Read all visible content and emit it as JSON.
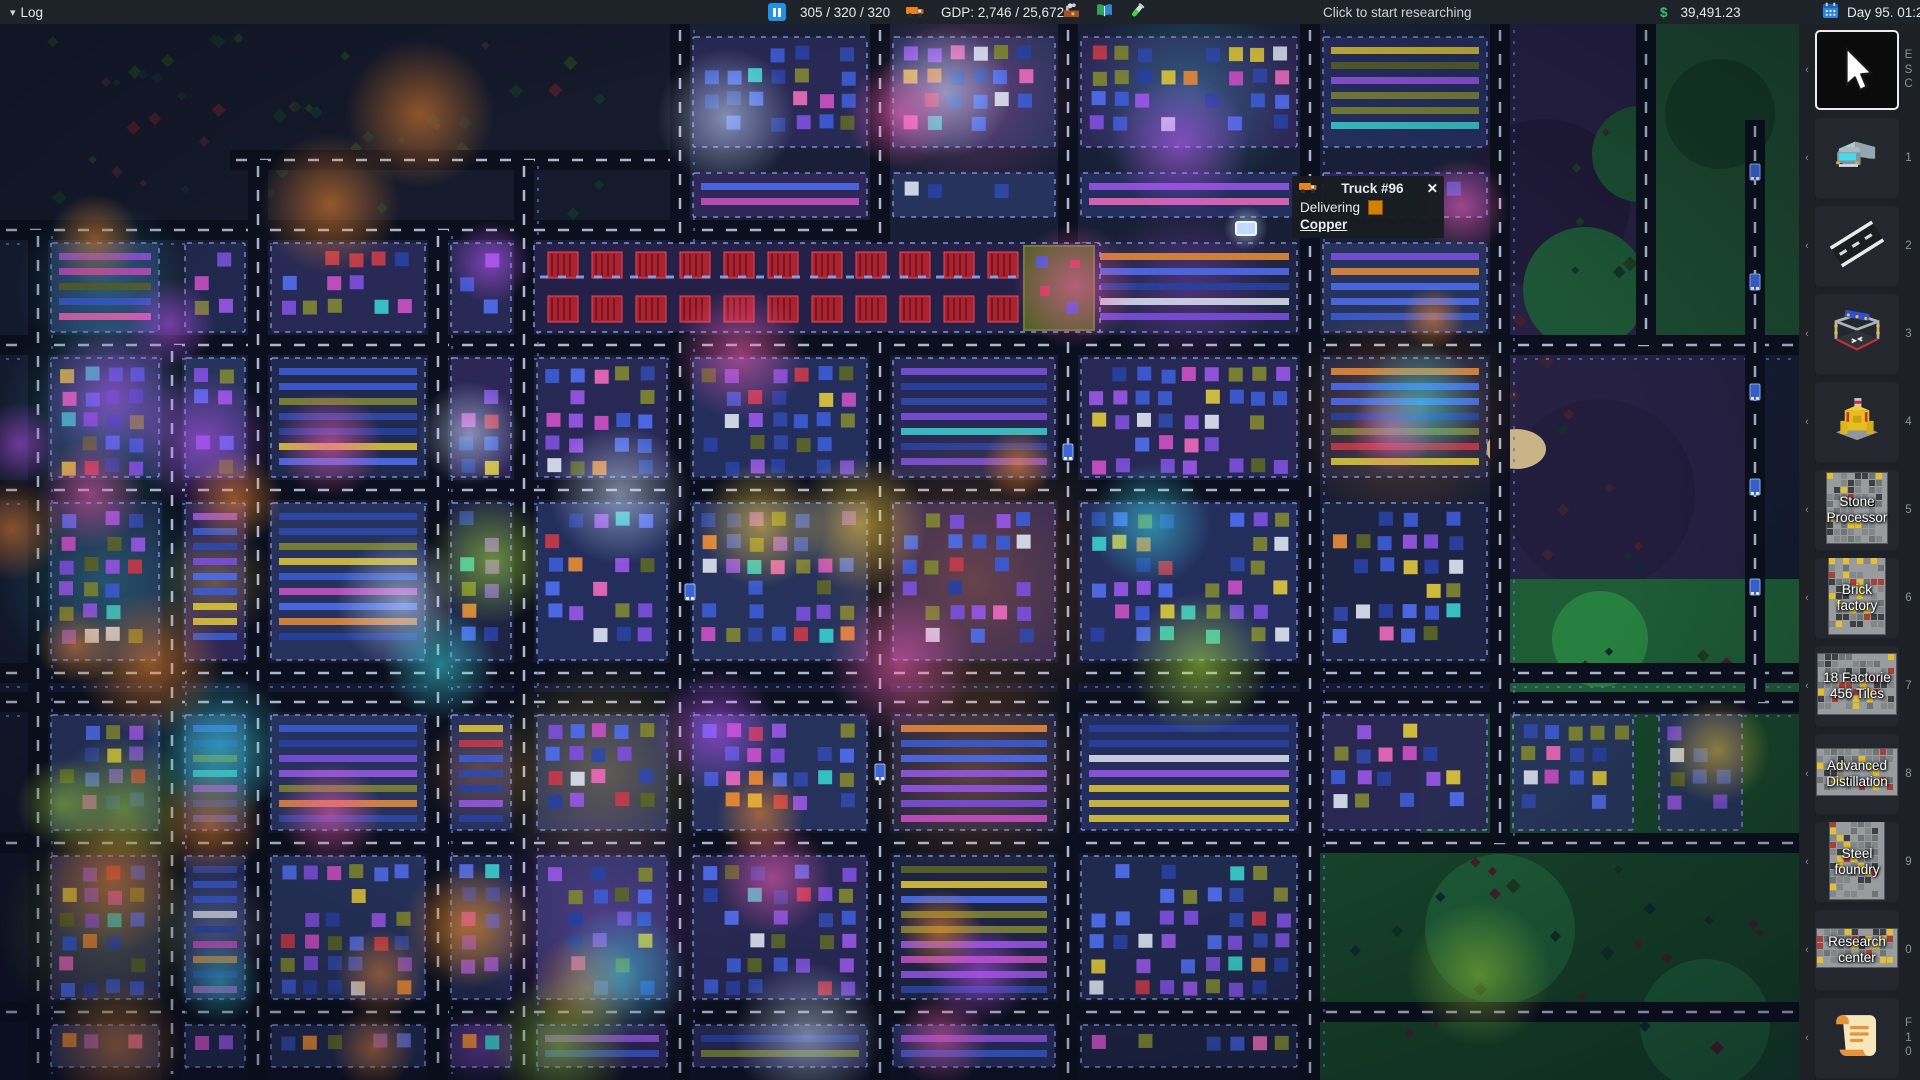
{
  "top_bar": {
    "log_label": "Log",
    "vehicles_count": "305 / 320 / 320",
    "gdp": "GDP: 2,746 / 25,672",
    "research_prompt": "Click to start researching",
    "currency_symbol": "$",
    "money": "39,491.23",
    "date": "Day 95. 01:20"
  },
  "tooltip": {
    "title": "Truck #96",
    "close": "✕",
    "status": "Delivering",
    "cargo": "Copper"
  },
  "sidebar": {
    "items": [
      {
        "id": "select-tool",
        "icon": "cursor",
        "shortcut": "ESC",
        "selected": true
      },
      {
        "id": "vehicle-tool",
        "icon": "truck",
        "shortcut": "1",
        "selected": false
      },
      {
        "id": "road-tool",
        "icon": "road",
        "shortcut": "2",
        "selected": false
      },
      {
        "id": "construction-tool",
        "icon": "construction",
        "shortcut": "3",
        "selected": false
      },
      {
        "id": "mining-factory",
        "icon": "factory",
        "shortcut": "4",
        "selected": false
      },
      {
        "id": "stone-processor",
        "icon": "blueprint",
        "label": "Stone\nProcessor",
        "shortcut": "5",
        "selected": false
      },
      {
        "id": "brick-factory",
        "icon": "blueprint",
        "label": "Brick\nfactory",
        "shortcut": "6",
        "selected": false
      },
      {
        "id": "factories-18",
        "icon": "blueprint",
        "label": "18 Factorie\n456 Tiles",
        "shortcut": "7",
        "selected": false
      },
      {
        "id": "advanced-distillation",
        "icon": "blueprint",
        "label": "Advanced\nDistillation",
        "shortcut": "8",
        "selected": false
      },
      {
        "id": "steel-foundry",
        "icon": "blueprint",
        "label": "Steel\nfoundry",
        "shortcut": "9",
        "selected": false
      },
      {
        "id": "research-center",
        "icon": "blueprint",
        "label": "Research\ncenter",
        "shortcut": "0",
        "selected": false
      },
      {
        "id": "log-scroll",
        "icon": "scroll",
        "shortcut": "F10",
        "selected": false
      }
    ]
  },
  "colors": {
    "topbar_bg": "#1e2329",
    "pause_blue": "#2093e8",
    "money_green": "#2bc46e",
    "cargo_orange": "#d77f00",
    "selected_border": "#ececec",
    "map_glows": [
      "#ff8c2e",
      "#ff5fb8",
      "#c555ff",
      "#3cd8e8",
      "#a8e03c",
      "#ffd23c",
      "#cfe0ff"
    ]
  }
}
